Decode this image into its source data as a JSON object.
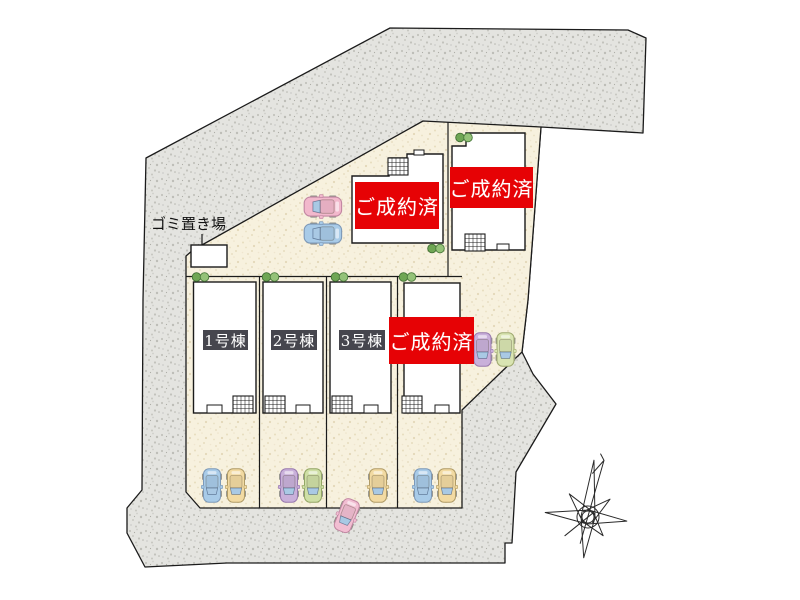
{
  "site_plan": {
    "garbage_area_label": "ゴミ置き場",
    "top_buildings": [
      {
        "status_label": "ご成約済"
      },
      {
        "status_label": "ご成約済"
      }
    ],
    "row_houses": [
      {
        "label": "1号棟"
      },
      {
        "label": "2号棟"
      },
      {
        "label": "3号棟"
      },
      {
        "status_label": "ご成約済"
      }
    ],
    "colors": {
      "sold_badge_bg": "#e60205",
      "sold_badge_text": "#ffffff",
      "house_number_bg": "#46464e",
      "house_number_text": "#ffffff",
      "site_ground": "#f7f1de",
      "surrounding_ground": "#e4e4e0",
      "outline": "#1b1b1b",
      "bush_green_dark": "#6fa654",
      "bush_green_light": "#94c278",
      "car_blue": "#a8cbe8",
      "car_yellow": "#f2daa2",
      "car_pink": "#f2bed2",
      "car_purple": "#c9b0da",
      "car_green": "#cfdfa6",
      "car_windshield": "#a9c9e4"
    }
  }
}
